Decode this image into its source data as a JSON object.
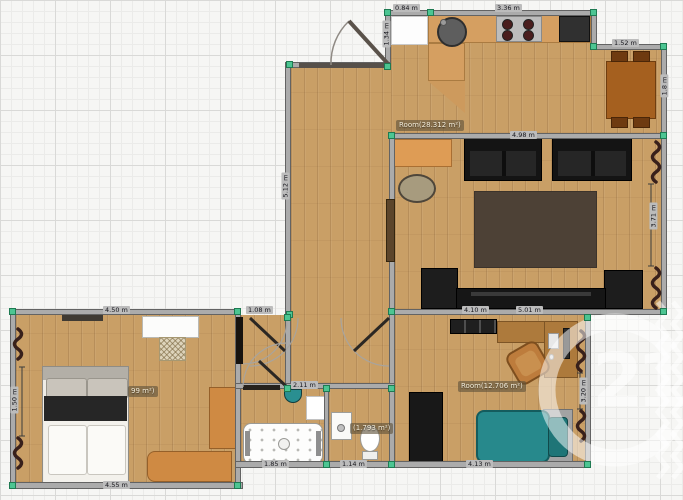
{
  "watermark": {
    "number": "21"
  },
  "rooms": {
    "open_plan": {
      "label": "Room(28.312 m²)"
    },
    "office": {
      "label": "Room(12.706 m²)"
    },
    "bathroom": {
      "label": "(1.793 m²)"
    },
    "bedroom": {
      "label_fragment": "99 m²)"
    }
  },
  "dimensions": {
    "kitchen_top_a": "0.84 m",
    "kitchen_top_b": "3.36 m",
    "kitchen_left": "1.34 m",
    "dining_top": "1.52 m",
    "dining_right": "1.8 m",
    "living_top": "4.98 m",
    "living_right": "3.71 m",
    "hall_left": "5.12 m",
    "living_bottom": "5.01 m",
    "office_top": "4.10 m",
    "office_bottom": "4.13 m",
    "office_right": "3.20 m",
    "bedroom_top": "4.50 m",
    "bedroom_bottom": "4.55 m",
    "bedroom_left": "1.50 m",
    "corridor_top": "1.08 m",
    "bathroom_top": "2.11 m",
    "bathroom_bottom_left": "1.85 m",
    "bathroom_bottom_right": "1.14 m"
  },
  "colors": {
    "wall": "#ababab",
    "floor_wood": "#c99f66",
    "handle_green": "#4cc592",
    "sofa_black": "#141414",
    "furniture_orange": "#cf8a43",
    "bed_teal": "#27898c",
    "curtain_brown": "#38201b",
    "watermark_white": "rgba(255,255,255,0.55)"
  }
}
